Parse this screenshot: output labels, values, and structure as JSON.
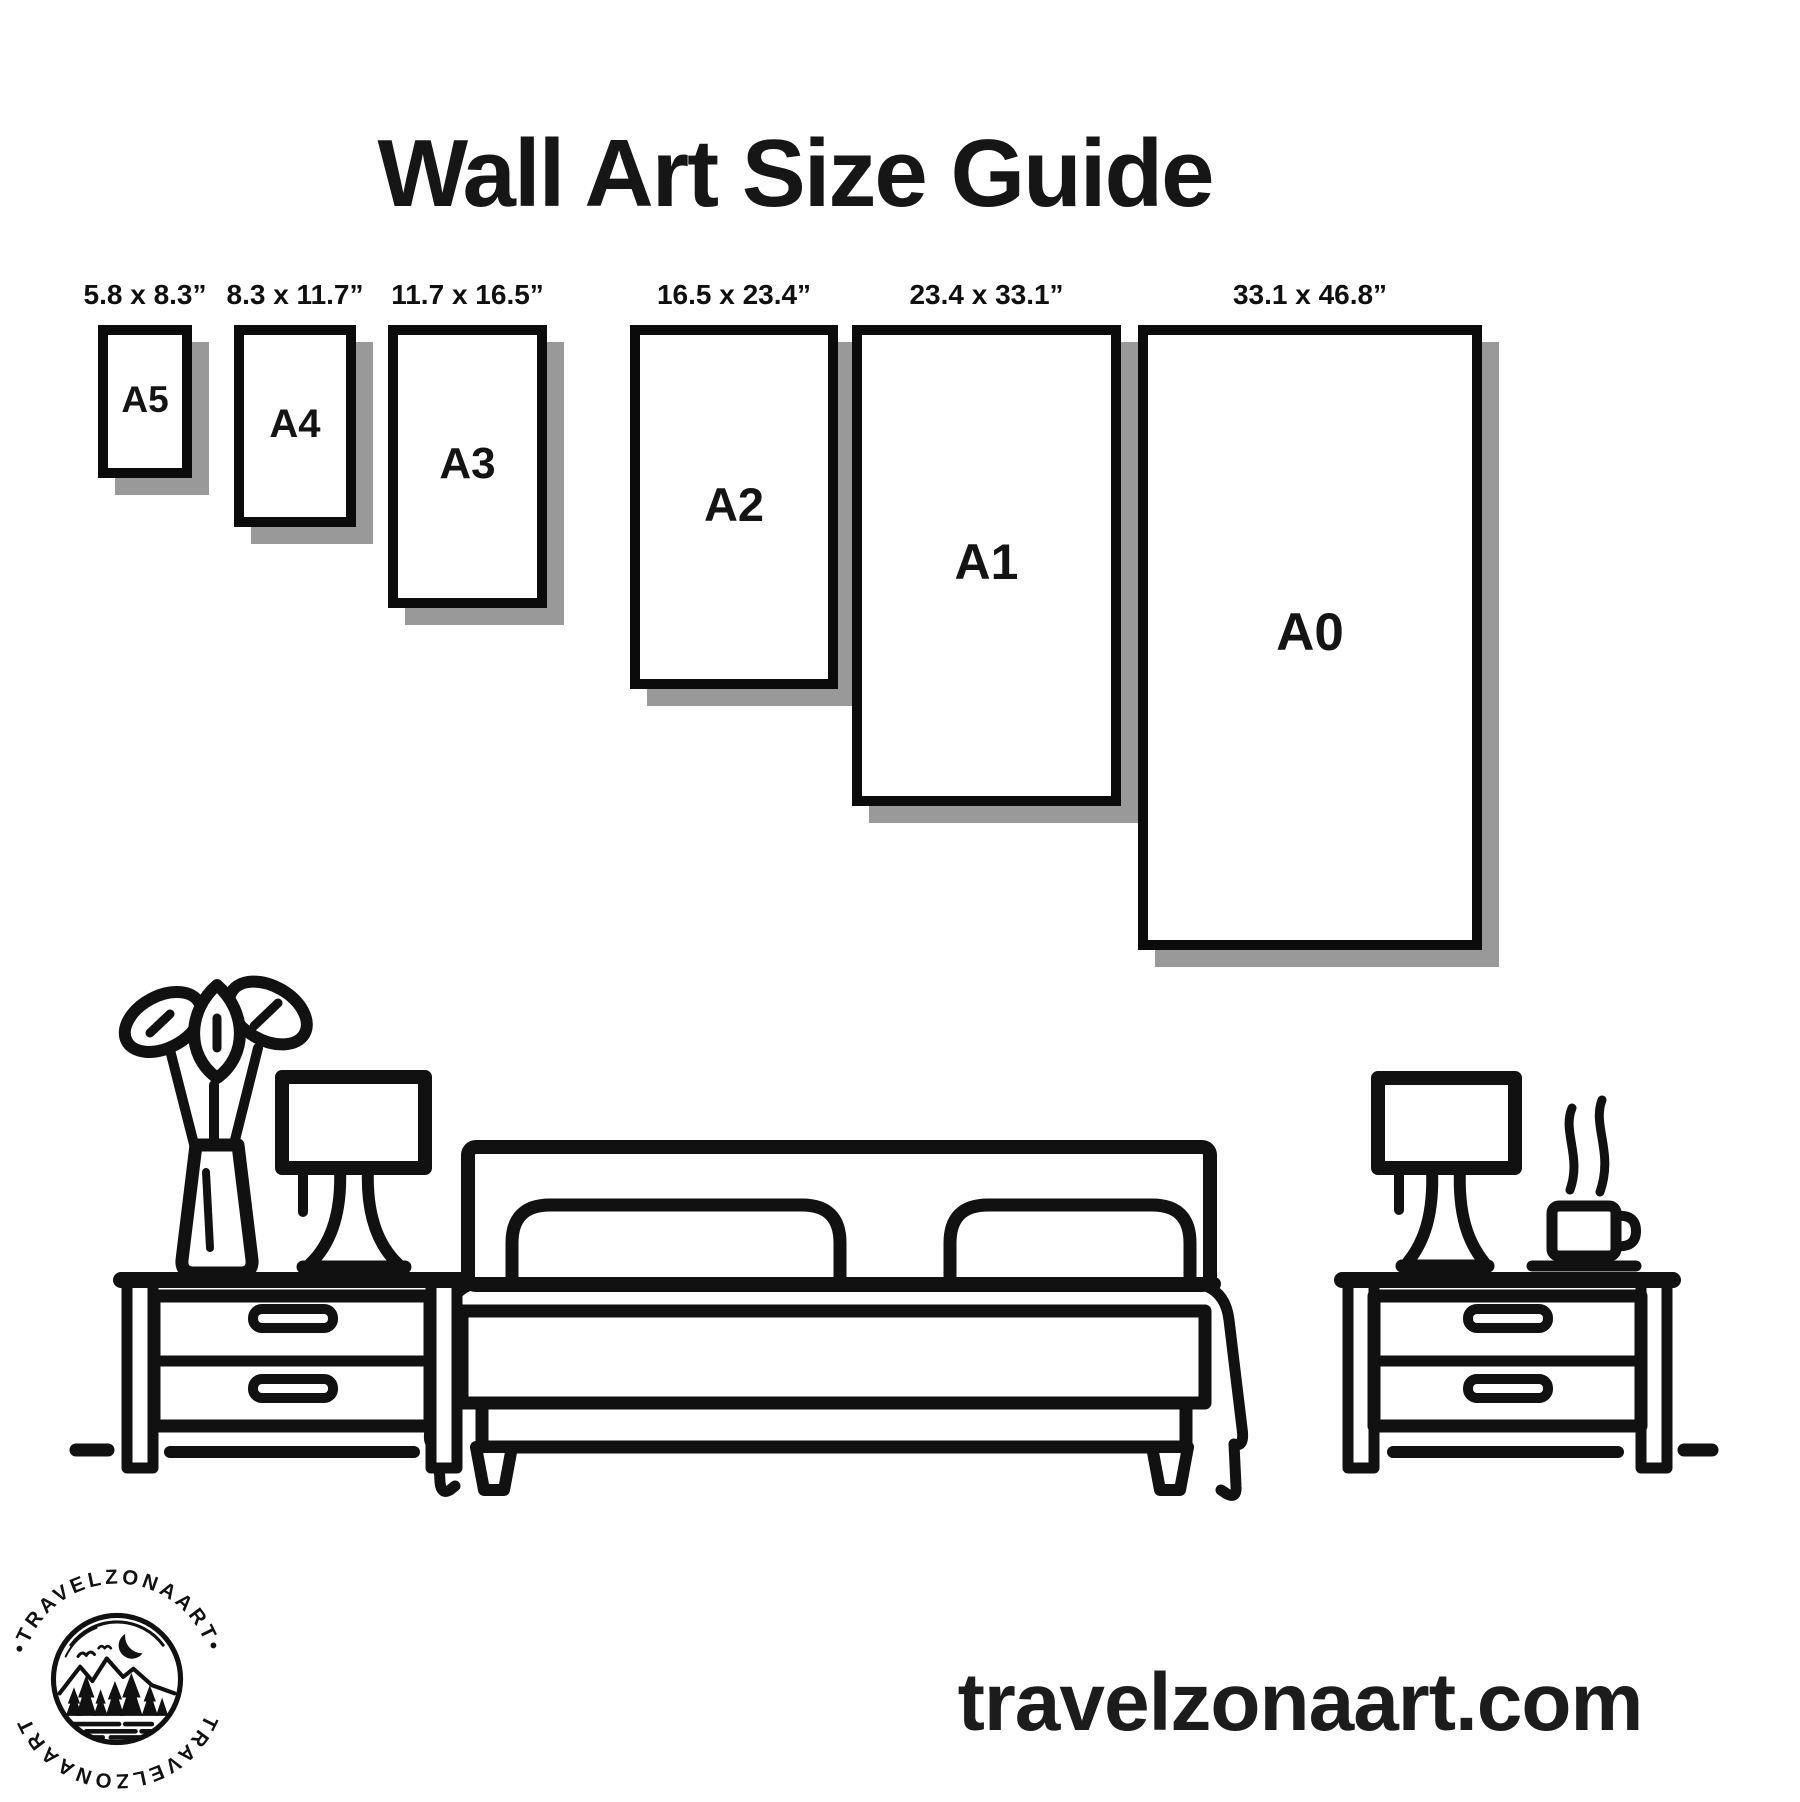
{
  "page_title": "Wall Art Size Guide",
  "sizes": [
    {
      "name": "A5",
      "dimensions": "5.8 x 8.3”"
    },
    {
      "name": "A4",
      "dimensions": "8.3 x 11.7”"
    },
    {
      "name": "A3",
      "dimensions": "11.7 x 16.5”"
    },
    {
      "name": "A2",
      "dimensions": "16.5 x 23.4”"
    },
    {
      "name": "A1",
      "dimensions": "23.4 x 33.1”"
    },
    {
      "name": "A0",
      "dimensions": "33.1 x 46.8”"
    }
  ],
  "logo": {
    "brand_arc_top": "•TRAVELZONAART•",
    "brand_arc_bottom": "TRAVELZONAART"
  },
  "footer": {
    "website": "travelzonaart.com"
  },
  "colors": {
    "ink": "#111111",
    "frame_border": "#0b0b0b",
    "shadow": "#999999",
    "background": "#ffffff"
  },
  "scene": {
    "icons": [
      "plant-vase-icon",
      "table-lamp-icon",
      "bed-icon",
      "nightstand-icon",
      "coffee-cup-icon",
      "steam-icon",
      "floor-line"
    ]
  }
}
